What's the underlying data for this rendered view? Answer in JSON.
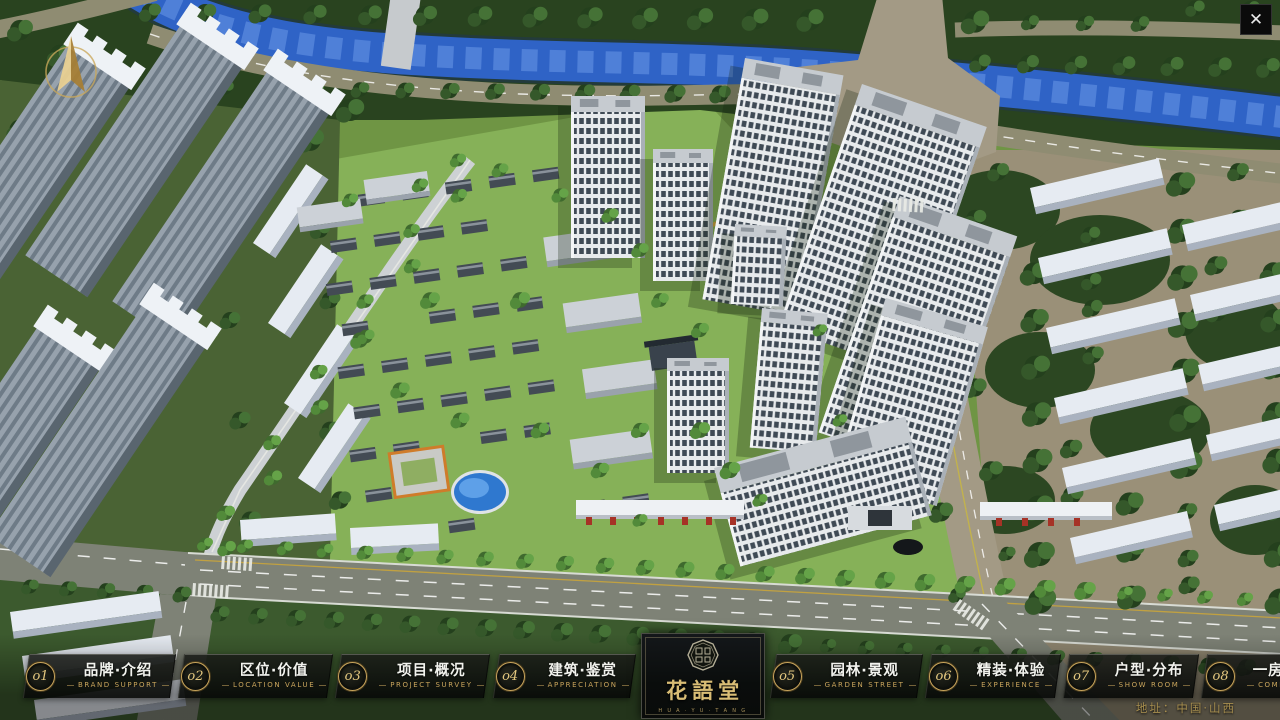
{
  "window": {
    "close_glyph": "✕"
  },
  "icons": {
    "close": "close-x",
    "compass": "north-arrow",
    "nav_badge": "gold-ring-number"
  },
  "nav": {
    "items": [
      {
        "num": "o1",
        "label": "品牌·介绍",
        "sub": "BRAND SUPPORT"
      },
      {
        "num": "o2",
        "label": "区位·价值",
        "sub": "LOCATION VALUE"
      },
      {
        "num": "o3",
        "label": "项目·概况",
        "sub": "PROJECT SURVEY"
      },
      {
        "num": "o4",
        "label": "建筑·鉴赏",
        "sub": "APPRECIATION"
      },
      {
        "num": "o5",
        "label": "园林·景观",
        "sub": "GARDEN STREET"
      },
      {
        "num": "o6",
        "label": "精装·体验",
        "sub": "EXPERIENCE"
      },
      {
        "num": "o7",
        "label": "户型·分布",
        "sub": "SHOW ROOM"
      },
      {
        "num": "o8",
        "label": "一房·一景",
        "sub": "COMMUNITY"
      }
    ]
  },
  "logo": {
    "title": "花語堂",
    "subtext": "H U A · Y U · T A N G"
  },
  "footer": {
    "address": "地址：中国·山西"
  },
  "colors": {
    "gold": "#c9a55c",
    "gold_bright": "#e4c87f",
    "nav_text": "#f2f3ee",
    "river": "#2f63c6",
    "lawn": "#7ba24e",
    "forest": "#29431f",
    "tower_white": "#e9ecee",
    "road": "#c3c7cb",
    "khaki_road": "#8f8c72",
    "asphalt": "#7e8276",
    "tan": "#9a9078",
    "roof_dark": "#414a53"
  }
}
